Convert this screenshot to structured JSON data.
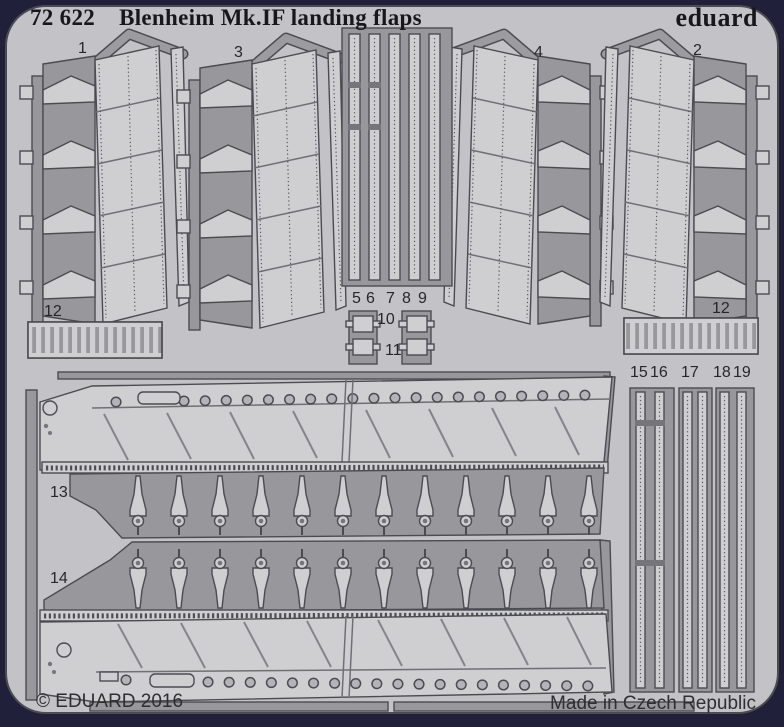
{
  "header": {
    "catalog_number": "72 622",
    "title": "Blenheim Mk.IF landing flaps",
    "brand": "eduard"
  },
  "footer": {
    "copyright": "© EDUARD 2016",
    "origin": "Made in Czech Republic"
  },
  "part_labels": [
    {
      "label": "1"
    },
    {
      "label": "3"
    },
    {
      "label": "4"
    },
    {
      "label": "2"
    },
    {
      "label": "5"
    },
    {
      "label": "6"
    },
    {
      "label": "7"
    },
    {
      "label": "8"
    },
    {
      "label": "9"
    },
    {
      "label": "10"
    },
    {
      "label": "11"
    },
    {
      "label": "12"
    },
    {
      "label": "12"
    },
    {
      "label": "13"
    },
    {
      "label": "14"
    },
    {
      "label": "15"
    },
    {
      "label": "16"
    },
    {
      "label": "17"
    },
    {
      "label": "18"
    },
    {
      "label": "19"
    }
  ],
  "colors": {
    "background_navy": "#20203a",
    "sheet_grey": "#c3c3c7",
    "etched_part_grey": "#cfcfd2",
    "waste_frame_grey": "#97979c",
    "text_dark": "#17171c"
  }
}
